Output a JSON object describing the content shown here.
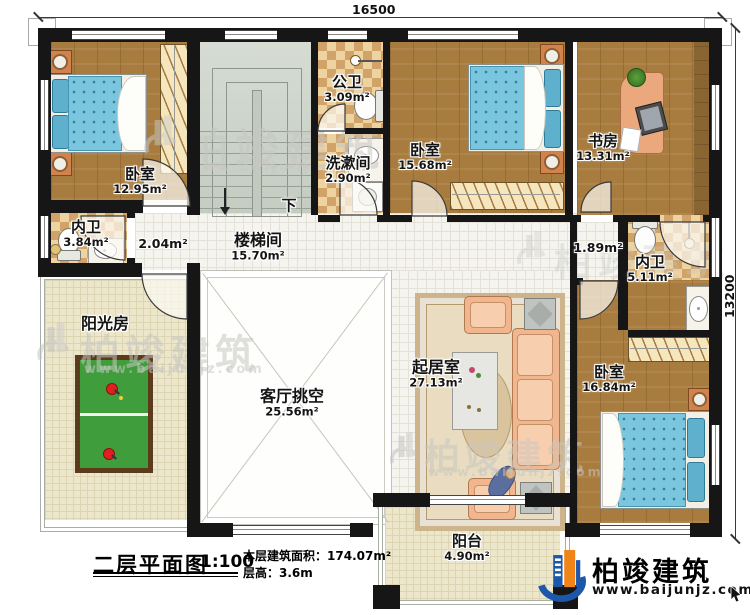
{
  "dimensions": {
    "top": "16500",
    "right": "13200"
  },
  "rooms": {
    "bedroom_nw": {
      "name": "卧室",
      "area": "12.95m²"
    },
    "ensuite_nw": {
      "name": "内卫",
      "area": "3.84m²"
    },
    "public_bath": {
      "name": "公卫",
      "area": "3.09m²"
    },
    "washroom": {
      "name": "洗漱间",
      "area": "2.90m²"
    },
    "bedroom_n": {
      "name": "卧室",
      "area": "15.68m²"
    },
    "study": {
      "name": "书房",
      "area": "13.31m²"
    },
    "stairwell": {
      "name": "楼梯间",
      "area": "15.70m²"
    },
    "hall_west": {
      "area": "2.04m²"
    },
    "hall_east": {
      "area": "1.89m²"
    },
    "ensuite_e": {
      "name": "内卫",
      "area": "5.11m²"
    },
    "bedroom_se": {
      "name": "卧室",
      "area": "16.84m²"
    },
    "living": {
      "name": "起居室",
      "area": "27.13m²"
    },
    "void": {
      "name": "客厅挑空",
      "area": "25.56m²"
    },
    "sunroom": {
      "name": "阳光房"
    },
    "balcony": {
      "name": "阳台",
      "area": "4.90m²"
    },
    "stair_down": "下"
  },
  "titleblock": {
    "title": "二层平面图",
    "scale": "1:100",
    "area_label": "本层建筑面积：",
    "area_value": "174.07m²",
    "floor_height_label": "层高：",
    "floor_height_value": "3.6m"
  },
  "logo": {
    "brand": "柏竣建筑",
    "url": "www.baijunjz.com"
  },
  "watermark": {
    "brand": "柏竣建筑",
    "url": "www.baijunjz.com"
  }
}
